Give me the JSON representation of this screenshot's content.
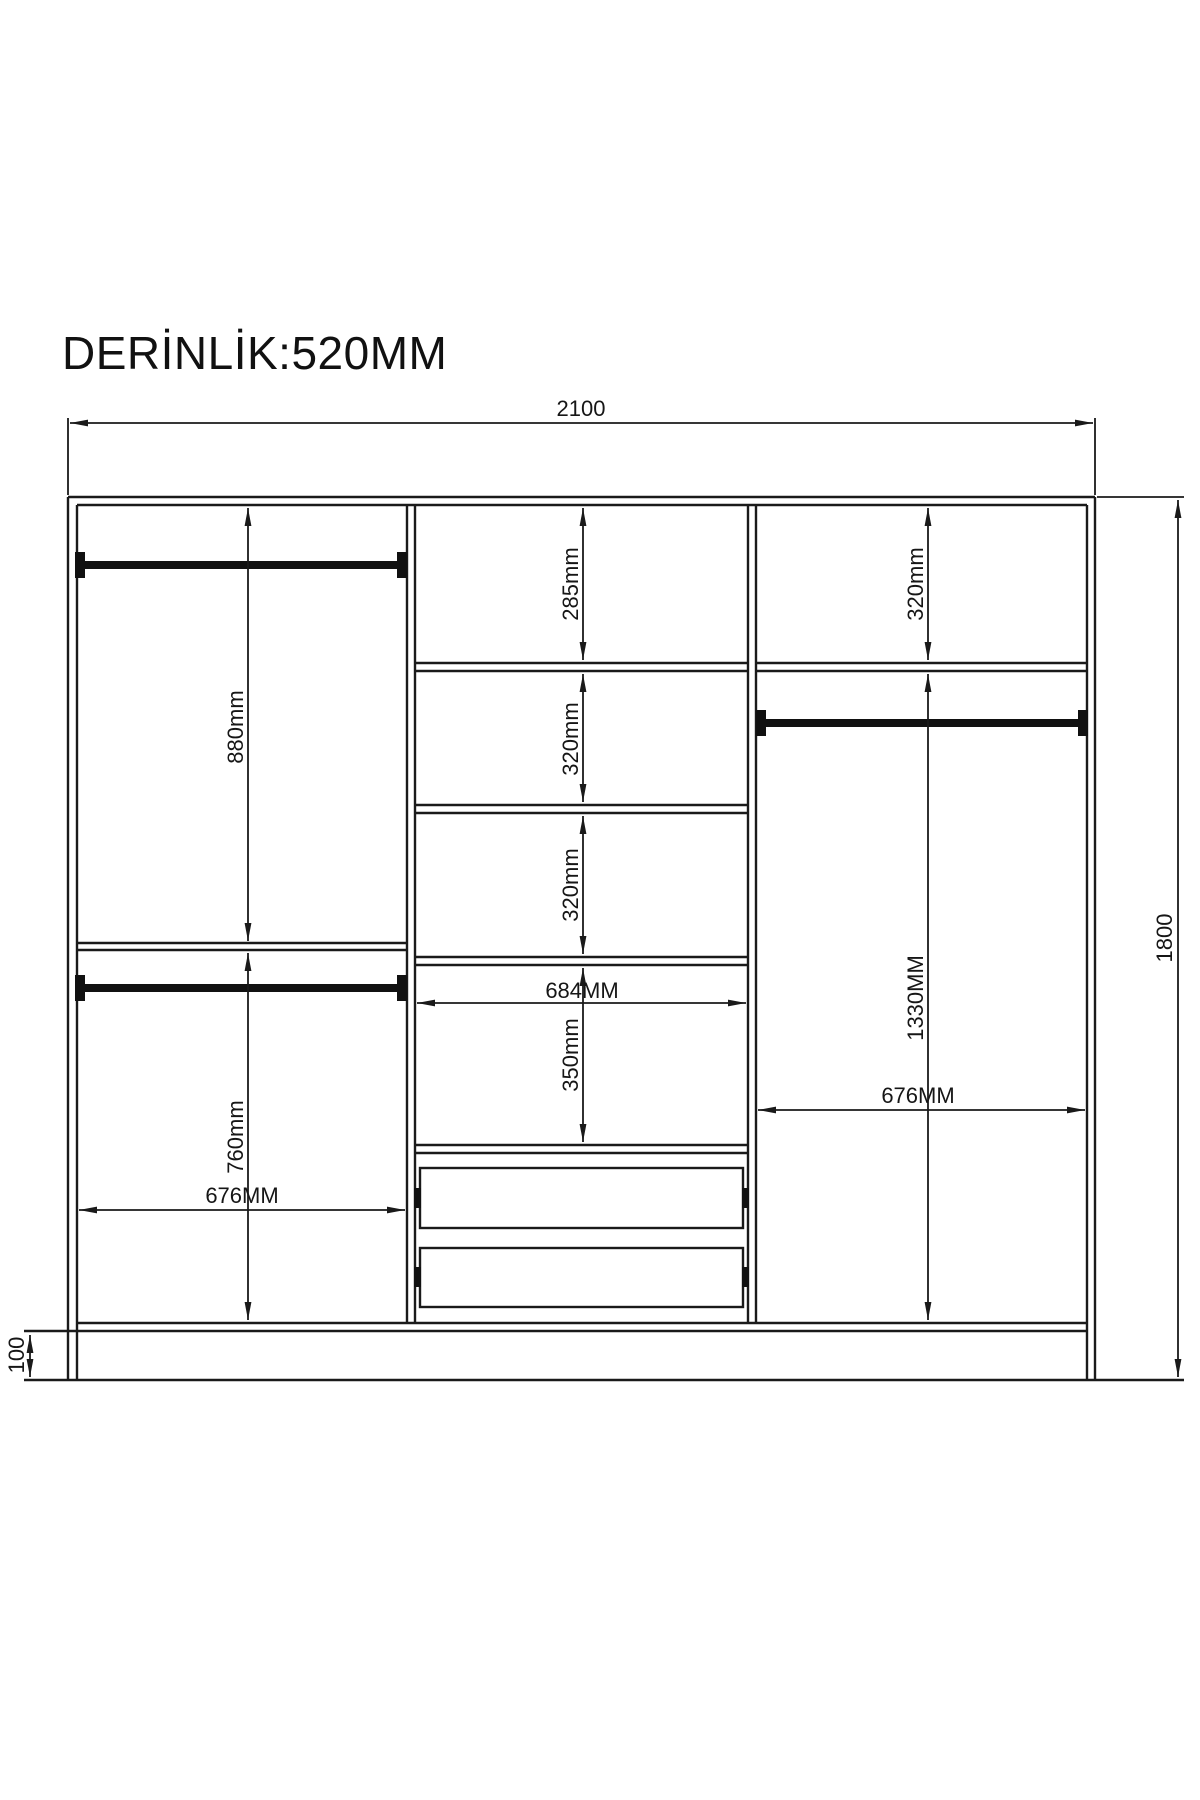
{
  "page": {
    "background": "#ffffff",
    "line_color": "#1a1a1a"
  },
  "title": "DERİNLİK:520MM",
  "dimensions": {
    "overall_width": "2100",
    "overall_height": "1800",
    "base_height": "100",
    "left": {
      "upper_height": "880mm",
      "lower_height": "760mm",
      "width": "676MM"
    },
    "middle": {
      "compartment1": "285mm",
      "compartment2": "320mm",
      "compartment3": "320mm",
      "compartment4": "350mm",
      "width": "684MM"
    },
    "right": {
      "top_compartment": "320mm",
      "hanging_height": "1330MM",
      "width": "676MM"
    }
  }
}
